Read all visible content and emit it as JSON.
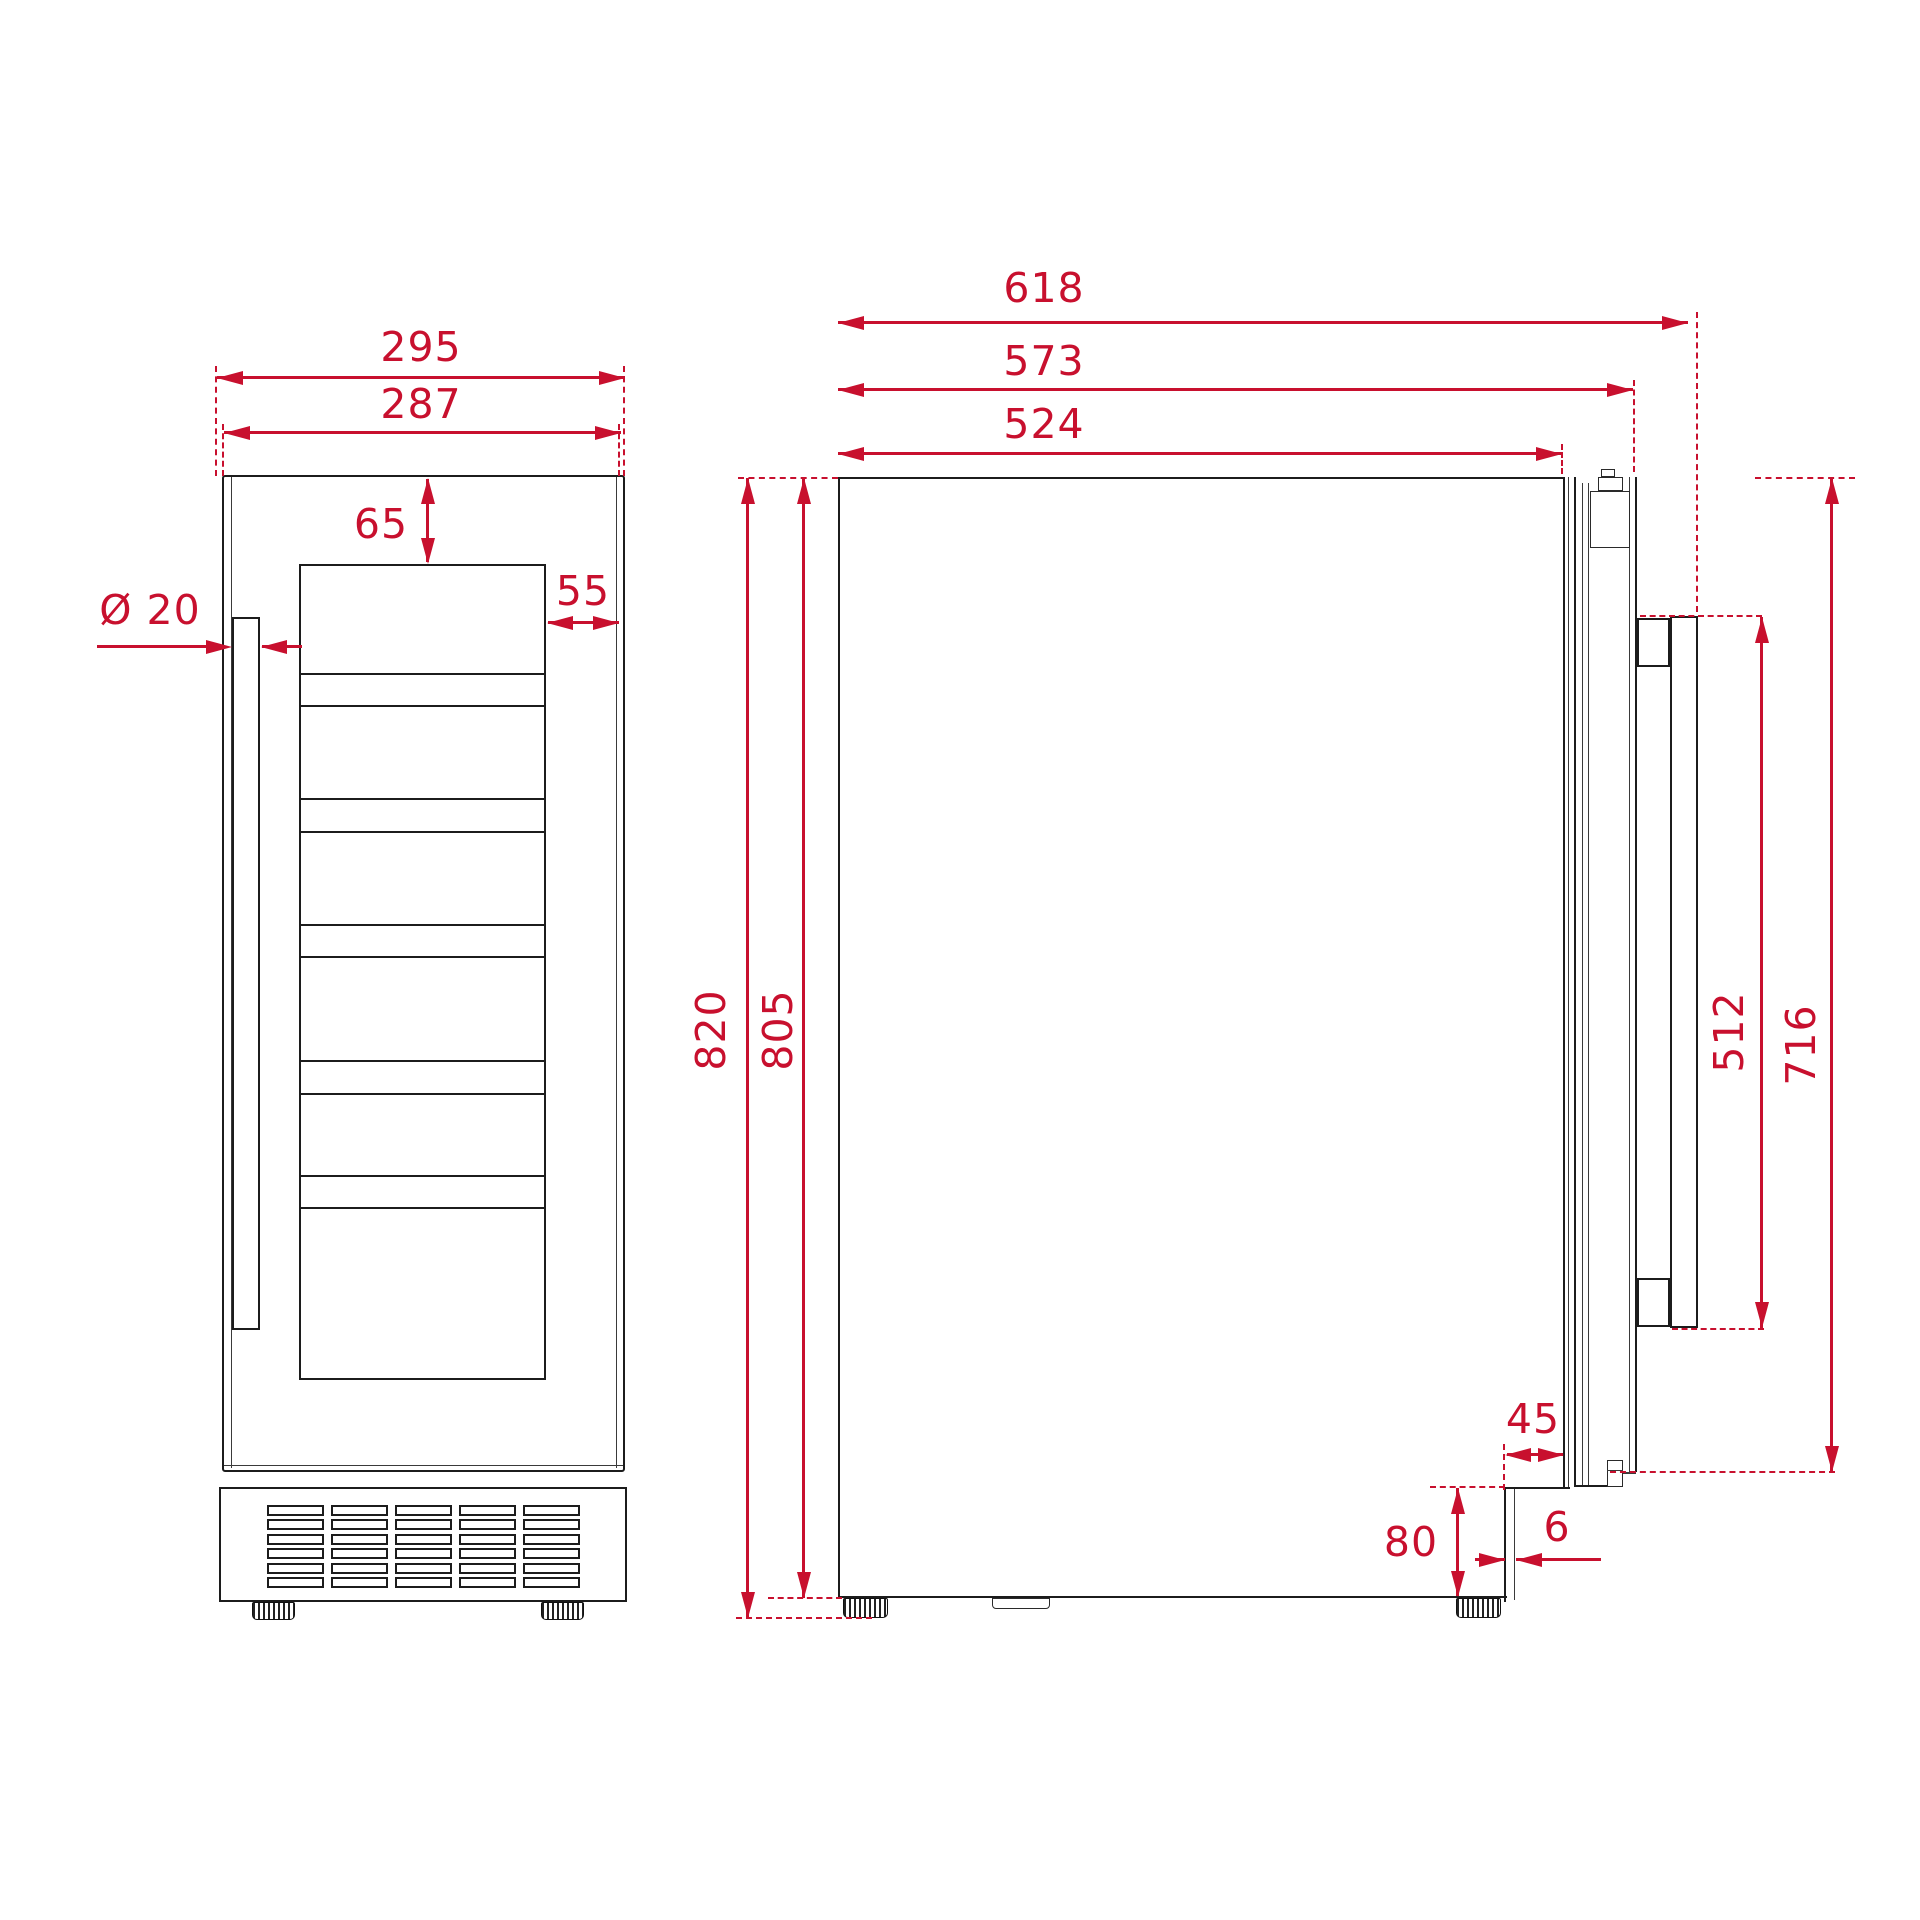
{
  "drawing": {
    "accent_color": "#C8102E",
    "line_color": "#1c1c1c",
    "background": "#ffffff"
  },
  "dimensions": {
    "front": {
      "niche_width": "295",
      "unit_width": "287",
      "top_clearance": "65",
      "side_clearance": "55",
      "handle_diameter": "Ø 20"
    },
    "side": {
      "depth_with_handle": "618",
      "depth_with_door": "573",
      "body_depth": "524",
      "total_height": "820",
      "body_height": "805",
      "handle_length": "512",
      "door_height": "716",
      "recess_depth": "45",
      "plinth_height": "80",
      "panel_thickness": "6"
    }
  },
  "grille": {
    "rows": 6,
    "cols": 5
  }
}
